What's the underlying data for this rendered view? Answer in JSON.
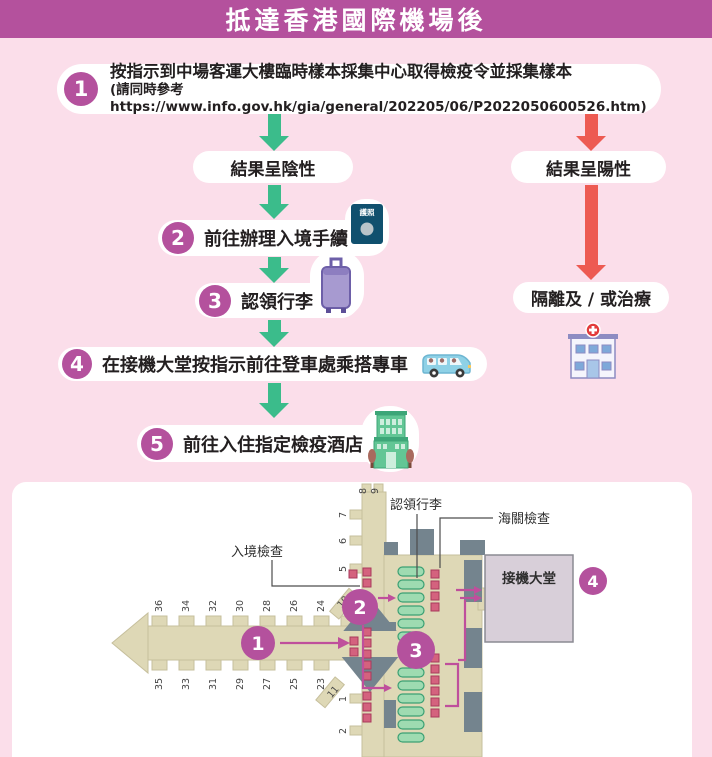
{
  "title": "抵達香港國際機場後",
  "flow": {
    "step1": {
      "num": "1",
      "line1": "按指示到中場客運大樓臨時樣本採集中心取得檢疫令並採集樣本",
      "line2": "(請同時參考 https://www.info.gov.hk/gia/general/202205/06/P2022050600526.htm)"
    },
    "result_negative": "結果呈陰性",
    "result_positive": "結果呈陽性",
    "step2": {
      "num": "2",
      "label": "前往辦理入境手續"
    },
    "step3": {
      "num": "3",
      "label": "認領行李"
    },
    "step4": {
      "num": "4",
      "label": "在接機大堂按指示前往登車處乘搭專車"
    },
    "step5": {
      "num": "5",
      "label": "前往入住指定檢疫酒店"
    },
    "isolation": "隔離及 / 或治療",
    "passport_text": "護照"
  },
  "map": {
    "labels": {
      "immigration": "入境檢查",
      "baggage_claim": "認領行李",
      "customs": "海關檢查",
      "arrival_hall": "接機大堂"
    },
    "markers": {
      "p1": "1",
      "p2": "2",
      "p3": "3",
      "p4": "4"
    },
    "gates_top": [
      "36",
      "34",
      "32",
      "30",
      "28",
      "26",
      "24",
      "12"
    ],
    "gates_bottom": [
      "35",
      "33",
      "31",
      "29",
      "27",
      "25",
      "23"
    ],
    "gate_10": "10",
    "gate_11": "11",
    "pier_gates": {
      "g8": "8",
      "g9": "9",
      "g7": "7",
      "g6": "6",
      "g5": "5",
      "g1": "1",
      "g2": "2"
    }
  },
  "colors": {
    "header": "#b4519d",
    "background": "#fbdeea",
    "negative_arrow": "#3bbc8b",
    "positive_arrow": "#ed5a52",
    "marker": "#b4519d",
    "terminal_beige": "#ded8b6",
    "structure_gray": "#74848e",
    "carousel_green": "#9edbb1",
    "counter_pink": "#d4627e",
    "arrival_hall": "#d8cfd9"
  }
}
